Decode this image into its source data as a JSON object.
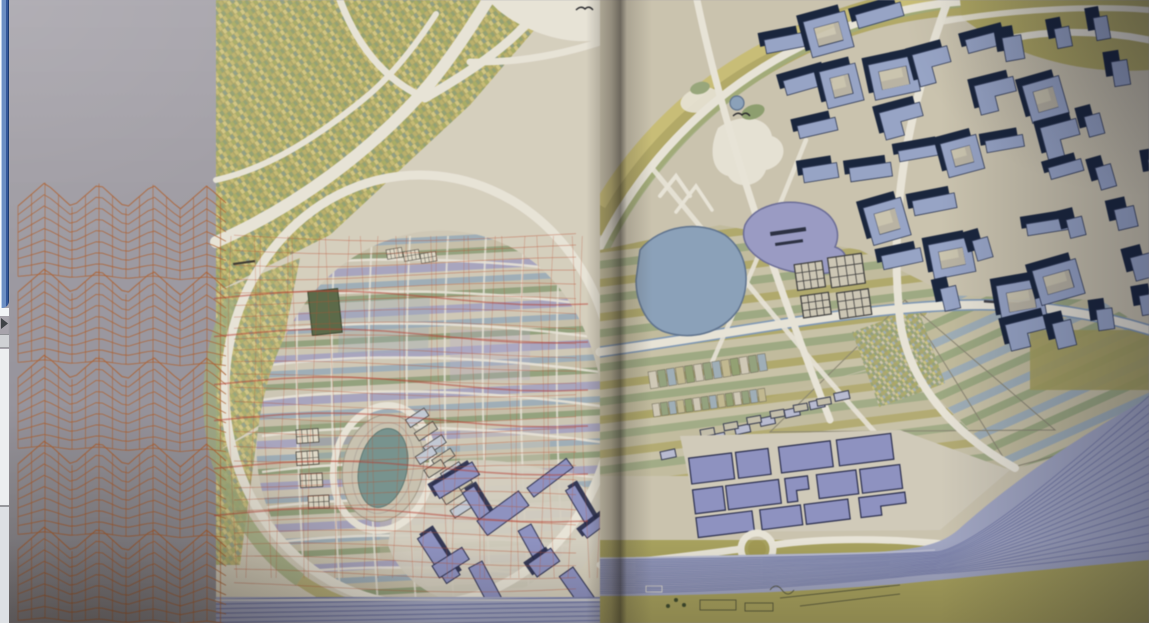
{
  "meta": {
    "description": "Photograph of an open art-book spread showing a large coloured urban masterplan drawing: an orange perspective mesh overlays the left page, a ring road encloses striped city blocks and a stadium, blue axonometric building blocks fill the upper right page, two lakes sit at the centre and a fanned railway yard spreads across the lower right. A few pixels of another desktop window are visible along the left edge.",
    "width": 1149,
    "height": 623
  },
  "background_window": {
    "name": "desktop-window-sliver",
    "border_color": "#6c8fc4",
    "body_color": "#eceef0",
    "note": "only a few pixels of another window are visible along the left edge"
  },
  "book": {
    "left_page": {
      "features": [
        "diagonal-allotment-parcels",
        "curving-highways",
        "highway-interchange",
        "ring-road",
        "striped-city-blocks",
        "street-grid",
        "stadium-oval",
        "dark-green-block",
        "window-grid-buildings",
        "tilted-row-blocks",
        "purple-slab-buildings",
        "orange-accordion-mesh",
        "orange-overlay-grid",
        "railway-band"
      ]
    },
    "right_page": {
      "features": [
        "concentric-field-arcs",
        "park-with-pond",
        "white-footpath-blobs",
        "blue-lake",
        "lavender-lake",
        "hatched-grid-blocks",
        "striped-fields",
        "field-boundary-triangles",
        "canal-boulevard",
        "illegible-road-label",
        "diagonal-roads",
        "axonometric-building-district",
        "small-parcel-rows",
        "rowhouse-strips",
        "purple-footprint-district",
        "roundabout",
        "railway-yard-fan",
        "olive-fields",
        "sketched-structures",
        "bird-glyphs"
      ]
    }
  },
  "palette": {
    "pageMarginTop": "#aaa7af",
    "pageMarginBot": "#8e8b93",
    "mapBaseL": "#d8d1be",
    "mapBaseR": "#cdc5ae",
    "road": "#eae6d8",
    "outline": "#8a8570",
    "parcelBg": "#ada663",
    "pA": "#c9bd6e",
    "pB": "#a9af60",
    "pC": "#93a36f",
    "pD": "#d5c87d",
    "pE": "#8f9f82",
    "pF": "#bdb266",
    "olive": "#b2a95d",
    "oliveDeep": "#a39a4e",
    "paleGreen": "#9fae7a",
    "stripeCream": "#d2cab6",
    "stripeSlate": "#9fb0ba",
    "stripeCream2": "#c9c1a9",
    "stripeGreen": "#94a37c",
    "stripeCream3": "#cfc8b4",
    "stripeLav": "#a9a6c2",
    "lakeBlue": "#8aa2bd",
    "lakeBlueEdge": "#5d7390",
    "lakeLav": "#9a9cc8",
    "lakeLavEdge": "#6a6c9a",
    "bldgLight": "#97a5ca",
    "bldgDark": "#16233d",
    "bldgEdge": "#2e3a58",
    "purpleFlat": "#8e92c5",
    "purpleEdge": "#262b4e",
    "railBase": "#a2a7c6",
    "railLine": "#6d74a8",
    "mesh": "#b55f2b",
    "net": "#c24e2c",
    "netHeavy": "#c0372a",
    "stadiumField": "#76948e",
    "darkGreen": "#5a6a45",
    "sketch": "#4c4f33"
  },
  "generation": {
    "seed": 11,
    "mesh": {
      "x0": 18,
      "x1": 232,
      "top": 200,
      "bands": 5,
      "bandH": 86,
      "rows": 9,
      "period": 54,
      "ampMax": 24,
      "sample": 6.5,
      "vStep": 13.5
    },
    "net": {
      "x0": 234,
      "x1": 612,
      "y0": 236,
      "y1": 592,
      "hStep": 13,
      "vStep": 16
    },
    "streaksY": [
      298,
      336,
      384,
      420,
      468,
      515
    ],
    "cityStreets": {
      "ys": [
        268,
        300,
        332,
        366,
        400,
        436,
        472,
        508,
        544,
        576
      ],
      "xs": [
        300,
        335,
        372,
        410,
        448,
        486,
        524,
        560
      ]
    },
    "buildings": {
      "origin": [
        762,
        34
      ],
      "u": [
        46,
        -9
      ],
      "v": [
        15,
        46
      ],
      "cols": 9,
      "rows": 8,
      "jitter": 6,
      "poly": [
        [
          756,
          16
        ],
        [
          1149,
          6
        ],
        [
          1149,
          348
        ],
        [
          1042,
          352
        ],
        [
          948,
          316
        ],
        [
          862,
          246
        ],
        [
          788,
          150
        ],
        [
          754,
          74
        ]
      ]
    },
    "purpleDistrict": {
      "rows": [
        [
          446,
          26
        ],
        [
          478,
          24
        ],
        [
          506,
          20
        ]
      ],
      "x0": 692,
      "x1": 888,
      "angle": -7
    },
    "leftSlabs": {
      "cols": 4,
      "rows": 3,
      "x0": 432,
      "y0": 486,
      "dx": 48,
      "dy": 40,
      "angles": [
        -34,
        58
      ]
    },
    "rail": {
      "x0": 600,
      "lines": 19,
      "y0": 560,
      "dy": 1.85,
      "convX": 935,
      "convY0": 552,
      "convDy": 1.2,
      "endX": 1149,
      "endY0": 396,
      "endDy": 8.6
    },
    "parcelRows": [
      {
        "x": 648,
        "y": 372,
        "angle": -9,
        "n": 13,
        "cw": 8,
        "ch": 17
      },
      {
        "x": 652,
        "y": 404,
        "angle": -8,
        "n": 14,
        "cw": 7,
        "ch": 13
      }
    ],
    "rowhouses": [
      {
        "x": 660,
        "y": 452,
        "n": 8,
        "dx": 26,
        "dy": -3,
        "w": 15,
        "h": 8,
        "angle": -12,
        "fill": "#b9bdd4"
      },
      {
        "x": 700,
        "y": 430,
        "n": 6,
        "dx": 24,
        "dy": -2,
        "w": 14,
        "h": 7,
        "angle": -10,
        "fill": "#c6c0aa"
      }
    ],
    "hatchBlocks": {
      "angle": -8,
      "cx": 830,
      "cy": 290,
      "blocks": [
        [
          798,
          260,
          28,
          26
        ],
        [
          832,
          258,
          34,
          30
        ],
        [
          800,
          292,
          28,
          22
        ],
        [
          836,
          294,
          32,
          26
        ]
      ]
    },
    "tiltRows": [
      {
        "x": 424,
        "y": 408,
        "n": 6,
        "dx": 16,
        "w": 9,
        "h": 22,
        "angle": 57
      },
      {
        "x": 432,
        "y": 446,
        "n": 5,
        "dx": 16,
        "w": 9,
        "h": 20,
        "angle": 57
      }
    ],
    "gridBuildings": [
      [
        296,
        430,
        -4,
        0.85
      ],
      [
        296,
        452,
        -4,
        0.85
      ],
      [
        300,
        474,
        -3,
        0.85
      ],
      [
        308,
        496,
        -3,
        0.8
      ],
      [
        386,
        250,
        -10,
        0.6
      ],
      [
        403,
        252,
        -10,
        0.6
      ],
      [
        420,
        254,
        -10,
        0.6
      ]
    ]
  }
}
